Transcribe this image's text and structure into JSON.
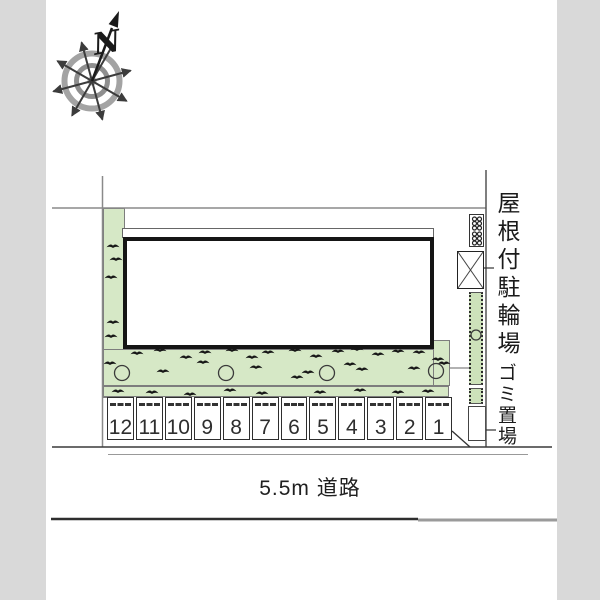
{
  "compass": {
    "north_label": "N"
  },
  "labels": {
    "road": "5.5m 道路",
    "covered_bicycle_parking": "屋根付駐輪場",
    "garbage_area": "ゴミ置場"
  },
  "parking": {
    "stalls": [
      "12",
      "11",
      "10",
      "9",
      "8",
      "7",
      "6",
      "5",
      "4",
      "3",
      "2",
      "1"
    ]
  },
  "colors": {
    "landscape_green": "#d6e8c6",
    "hedge_green": "#cde2ba",
    "margin_gray": "#d9d9d9",
    "line_dark": "#2e2e2e",
    "line_gray": "#8a8a8a"
  },
  "landscape": {
    "trees": [
      [
        122,
        373,
        7.5
      ],
      [
        226,
        373,
        7.5
      ],
      [
        327,
        373,
        7.5
      ],
      [
        436,
        371,
        7.5
      ],
      [
        476,
        335,
        5
      ]
    ],
    "tufts": [
      [
        113,
        246
      ],
      [
        116,
        259
      ],
      [
        111,
        277
      ],
      [
        113,
        322
      ],
      [
        111,
        336
      ],
      [
        110,
        363
      ],
      [
        137,
        353
      ],
      [
        160,
        350
      ],
      [
        186,
        357
      ],
      [
        205,
        352
      ],
      [
        232,
        350
      ],
      [
        252,
        357
      ],
      [
        268,
        352
      ],
      [
        295,
        350
      ],
      [
        316,
        356
      ],
      [
        338,
        351
      ],
      [
        357,
        349
      ],
      [
        378,
        354
      ],
      [
        398,
        351
      ],
      [
        419,
        352
      ],
      [
        438,
        359
      ],
      [
        163,
        371
      ],
      [
        203,
        362
      ],
      [
        256,
        367
      ],
      [
        308,
        372
      ],
      [
        297,
        377
      ],
      [
        350,
        364
      ],
      [
        362,
        369
      ],
      [
        414,
        368
      ],
      [
        444,
        363
      ],
      [
        118,
        391
      ],
      [
        152,
        392
      ],
      [
        190,
        394
      ],
      [
        230,
        390
      ],
      [
        262,
        393
      ],
      [
        320,
        392
      ],
      [
        360,
        390
      ],
      [
        398,
        392
      ],
      [
        428,
        391
      ]
    ]
  },
  "bike_rack": {
    "dots": [
      [
        474.5,
        219
      ],
      [
        479.5,
        219
      ],
      [
        474.5,
        223.5
      ],
      [
        479.5,
        223.5
      ],
      [
        474.5,
        228
      ],
      [
        479.5,
        228
      ],
      [
        474.5,
        234
      ],
      [
        479.5,
        234
      ],
      [
        474.5,
        238.5
      ],
      [
        479.5,
        238.5
      ],
      [
        474.5,
        243
      ],
      [
        479.5,
        243
      ]
    ]
  }
}
